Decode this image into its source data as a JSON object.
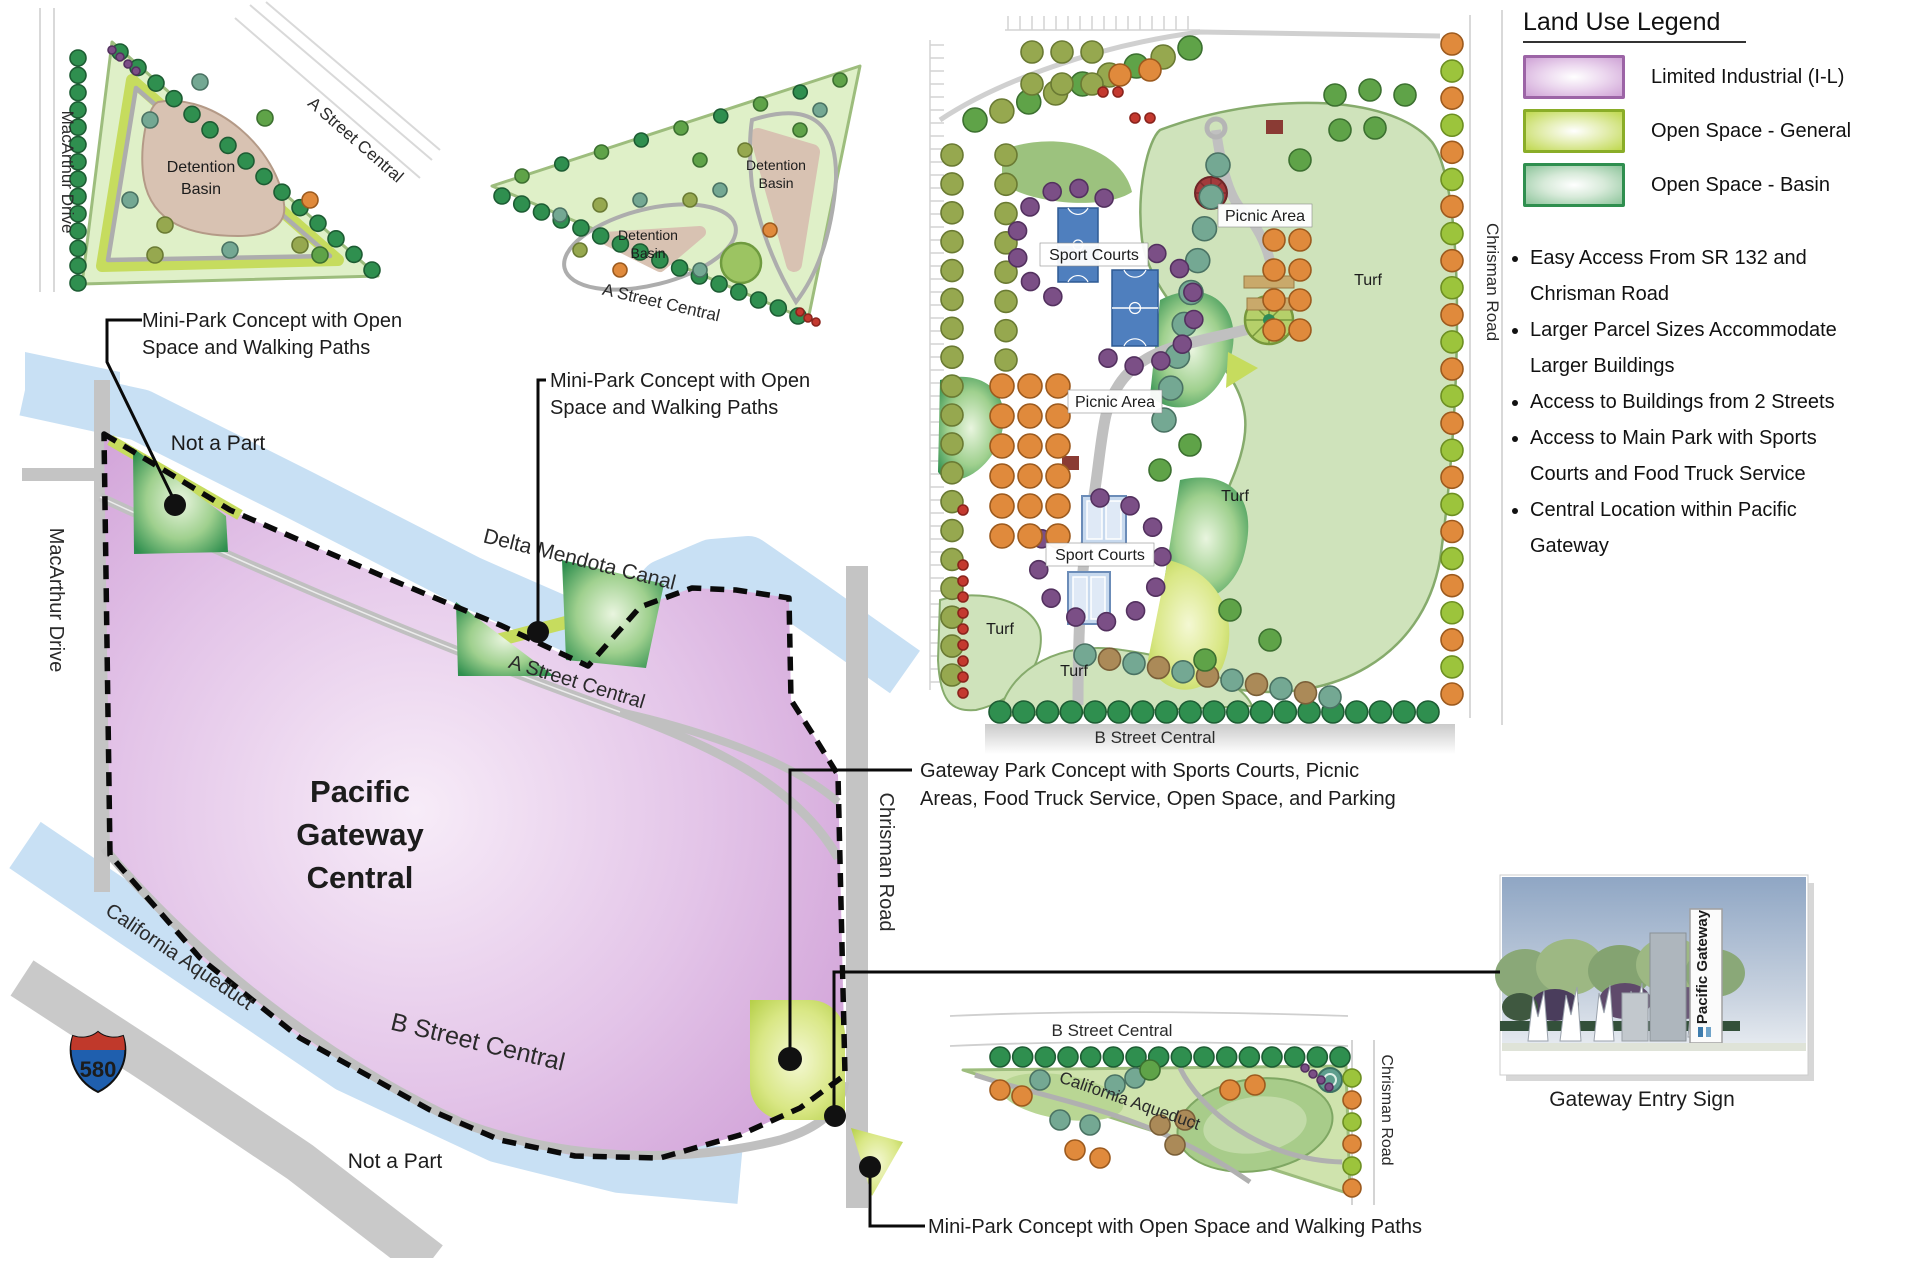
{
  "legend": {
    "title": "Land Use Legend",
    "items": [
      {
        "label": "Limited Industrial (I-L)",
        "color": "#cfa3d6",
        "border": "#9c64a6"
      },
      {
        "label": "Open Space - General",
        "color": "#bfd84e",
        "border": "#8aad28"
      },
      {
        "label": "Open Space - Basin",
        "color": "#8cc49a",
        "border": "#2f8f4f"
      }
    ]
  },
  "bullets": [
    "Easy Access From SR 132 and Chrisman Road",
    "Larger Parcel Sizes Accommodate Larger Buildings",
    "Access to Buildings from 2 Streets",
    "Access to Main Park with Sports Courts and Food Truck Service",
    "Central Location within Pacific Gateway"
  ],
  "main_map": {
    "title_line1": "Pacific",
    "title_line2": "Gateway",
    "title_line3": "Central",
    "macarthur_drive": "MacArthur Drive",
    "a_street": "A Street Central",
    "b_street": "B Street Central",
    "chrisman_road": "Chrisman Road",
    "delta_canal": "Delta Mendota Canal",
    "california_aqueduct": "California Aqueduct",
    "not_a_part_top": "Not a Part",
    "not_a_part_bottom": "Not a Part",
    "interstate_shield": "580"
  },
  "inset_topleft": {
    "macarthur_drive": "MacArthur Drive",
    "a_street": "A Street Central",
    "detention_basin_line1": "Detention",
    "detention_basin_line2": "Basin"
  },
  "inset_middle": {
    "a_street": "A Street Central",
    "basin1_line1": "Detention",
    "basin1_line2": "Basin",
    "basin2_line1": "Detention",
    "basin2_line2": "Basin"
  },
  "park": {
    "sport_courts_1": "Sport Courts",
    "sport_courts_2": "Sport Courts",
    "picnic_area_1": "Picnic Area",
    "picnic_area_2": "Picnic Area",
    "turf_label": "Turf",
    "chrisman_road": "Chrisman Road",
    "b_street": "B Street Central"
  },
  "inset_bottom": {
    "b_street": "B Street Central",
    "california_aqueduct": "California Aqueduct",
    "chrisman_road": "Chrisman Road"
  },
  "annotations": {
    "mini_park_1_line1": "Mini-Park Concept with Open",
    "mini_park_1_line2": "Space and Walking Paths",
    "mini_park_2_line1": "Mini-Park Concept with Open",
    "mini_park_2_line2": "Space and Walking Paths",
    "gateway_park_line1": "Gateway Park Concept with Sports Courts, Picnic",
    "gateway_park_line2": "Areas, Food Truck Service, Open Space, and Parking",
    "mini_park_3": "Mini-Park Concept with Open Space and Walking Paths"
  },
  "entry_sign": {
    "caption": "Gateway Entry Sign",
    "sign_text": "Pacific Gateway"
  }
}
